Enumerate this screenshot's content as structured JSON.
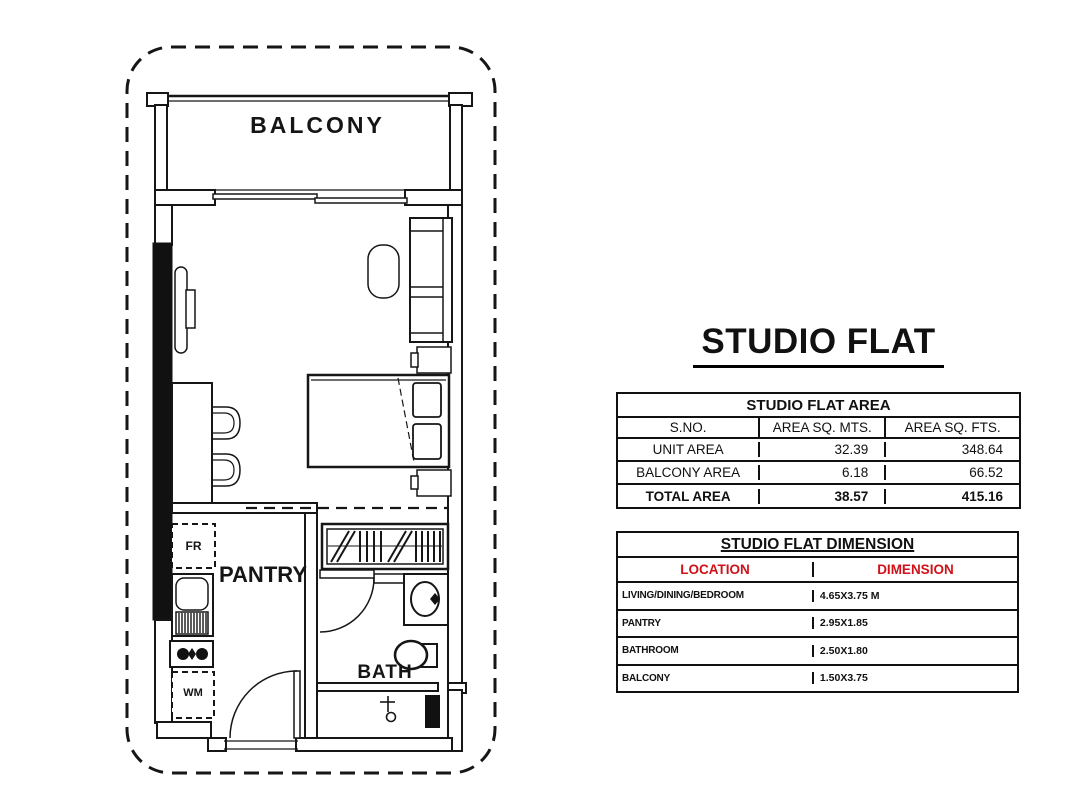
{
  "floorplan": {
    "rooms": {
      "balcony": "BALCONY",
      "pantry": "PANTRY",
      "bath": "BATH"
    },
    "fixtures": {
      "fridge": "FR",
      "washing_machine": "WM"
    }
  },
  "panel": {
    "title": "STUDIO FLAT",
    "area_table": {
      "title": "STUDIO FLAT AREA",
      "columns": [
        "S.NO.",
        "AREA SQ. MTS.",
        "AREA SQ. FTS."
      ],
      "rows": [
        {
          "label": "UNIT AREA",
          "sq_mts": "32.39",
          "sq_fts": "348.64"
        },
        {
          "label": "BALCONY AREA",
          "sq_mts": "6.18",
          "sq_fts": "66.52"
        },
        {
          "label": "TOTAL AREA",
          "sq_mts": "38.57",
          "sq_fts": "415.16"
        }
      ]
    },
    "dimension_table": {
      "title": "STUDIO FLAT DIMENSION",
      "columns": [
        "LOCATION",
        "DIMENSION"
      ],
      "header_color": "#d01119",
      "rows": [
        {
          "location": "LIVING/DINING/BEDROOM",
          "dimension": "4.65X3.75 M"
        },
        {
          "location": "PANTRY",
          "dimension": "2.95X1.85"
        },
        {
          "location": "BATHROOM",
          "dimension": "2.50X1.80"
        },
        {
          "location": "BALCONY",
          "dimension": "1.50X3.75"
        }
      ]
    }
  },
  "colors": {
    "line": "#111111",
    "header_red": "#d01119",
    "background": "#ffffff"
  }
}
